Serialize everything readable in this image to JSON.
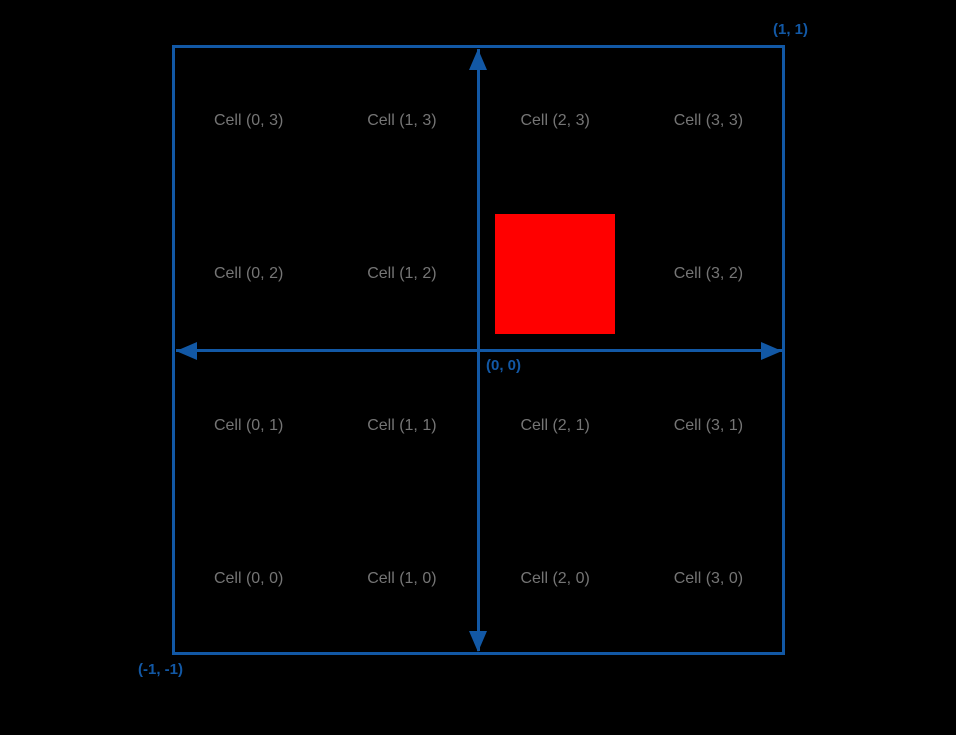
{
  "diagram": {
    "description": "clip-space-grid-diagram",
    "background_color": "#000000",
    "colors": {
      "axis": "#1258A5",
      "cell_text": "#757575",
      "square": "#FF0000"
    },
    "grid": {
      "columns": 4,
      "rows": 4
    },
    "corners": {
      "top_right": "(1, 1)",
      "bottom_left": "(-1, -1)",
      "origin": "(0, 0)"
    },
    "cells": [
      {
        "label": "Cell (0, 3)",
        "col": 0,
        "row": 3
      },
      {
        "label": "Cell (1, 3)",
        "col": 1,
        "row": 3
      },
      {
        "label": "Cell (2, 3)",
        "col": 2,
        "row": 3
      },
      {
        "label": "Cell (3, 3)",
        "col": 3,
        "row": 3
      },
      {
        "label": "Cell (0, 2)",
        "col": 0,
        "row": 2
      },
      {
        "label": "Cell (1, 2)",
        "col": 1,
        "row": 2
      },
      {
        "label": "Cell (3, 2)",
        "col": 3,
        "row": 2
      },
      {
        "label": "Cell (0, 1)",
        "col": 0,
        "row": 1
      },
      {
        "label": "Cell (1, 1)",
        "col": 1,
        "row": 1
      },
      {
        "label": "Cell (2, 1)",
        "col": 2,
        "row": 1
      },
      {
        "label": "Cell (3, 1)",
        "col": 3,
        "row": 1
      },
      {
        "label": "Cell (0, 0)",
        "col": 0,
        "row": 0
      },
      {
        "label": "Cell (1, 0)",
        "col": 1,
        "row": 0
      },
      {
        "label": "Cell (2, 0)",
        "col": 2,
        "row": 0
      },
      {
        "label": "Cell (3, 0)",
        "col": 3,
        "row": 0
      }
    ],
    "highlighted_square": {
      "col": 2,
      "row": 2,
      "color": "#FF0000"
    }
  }
}
